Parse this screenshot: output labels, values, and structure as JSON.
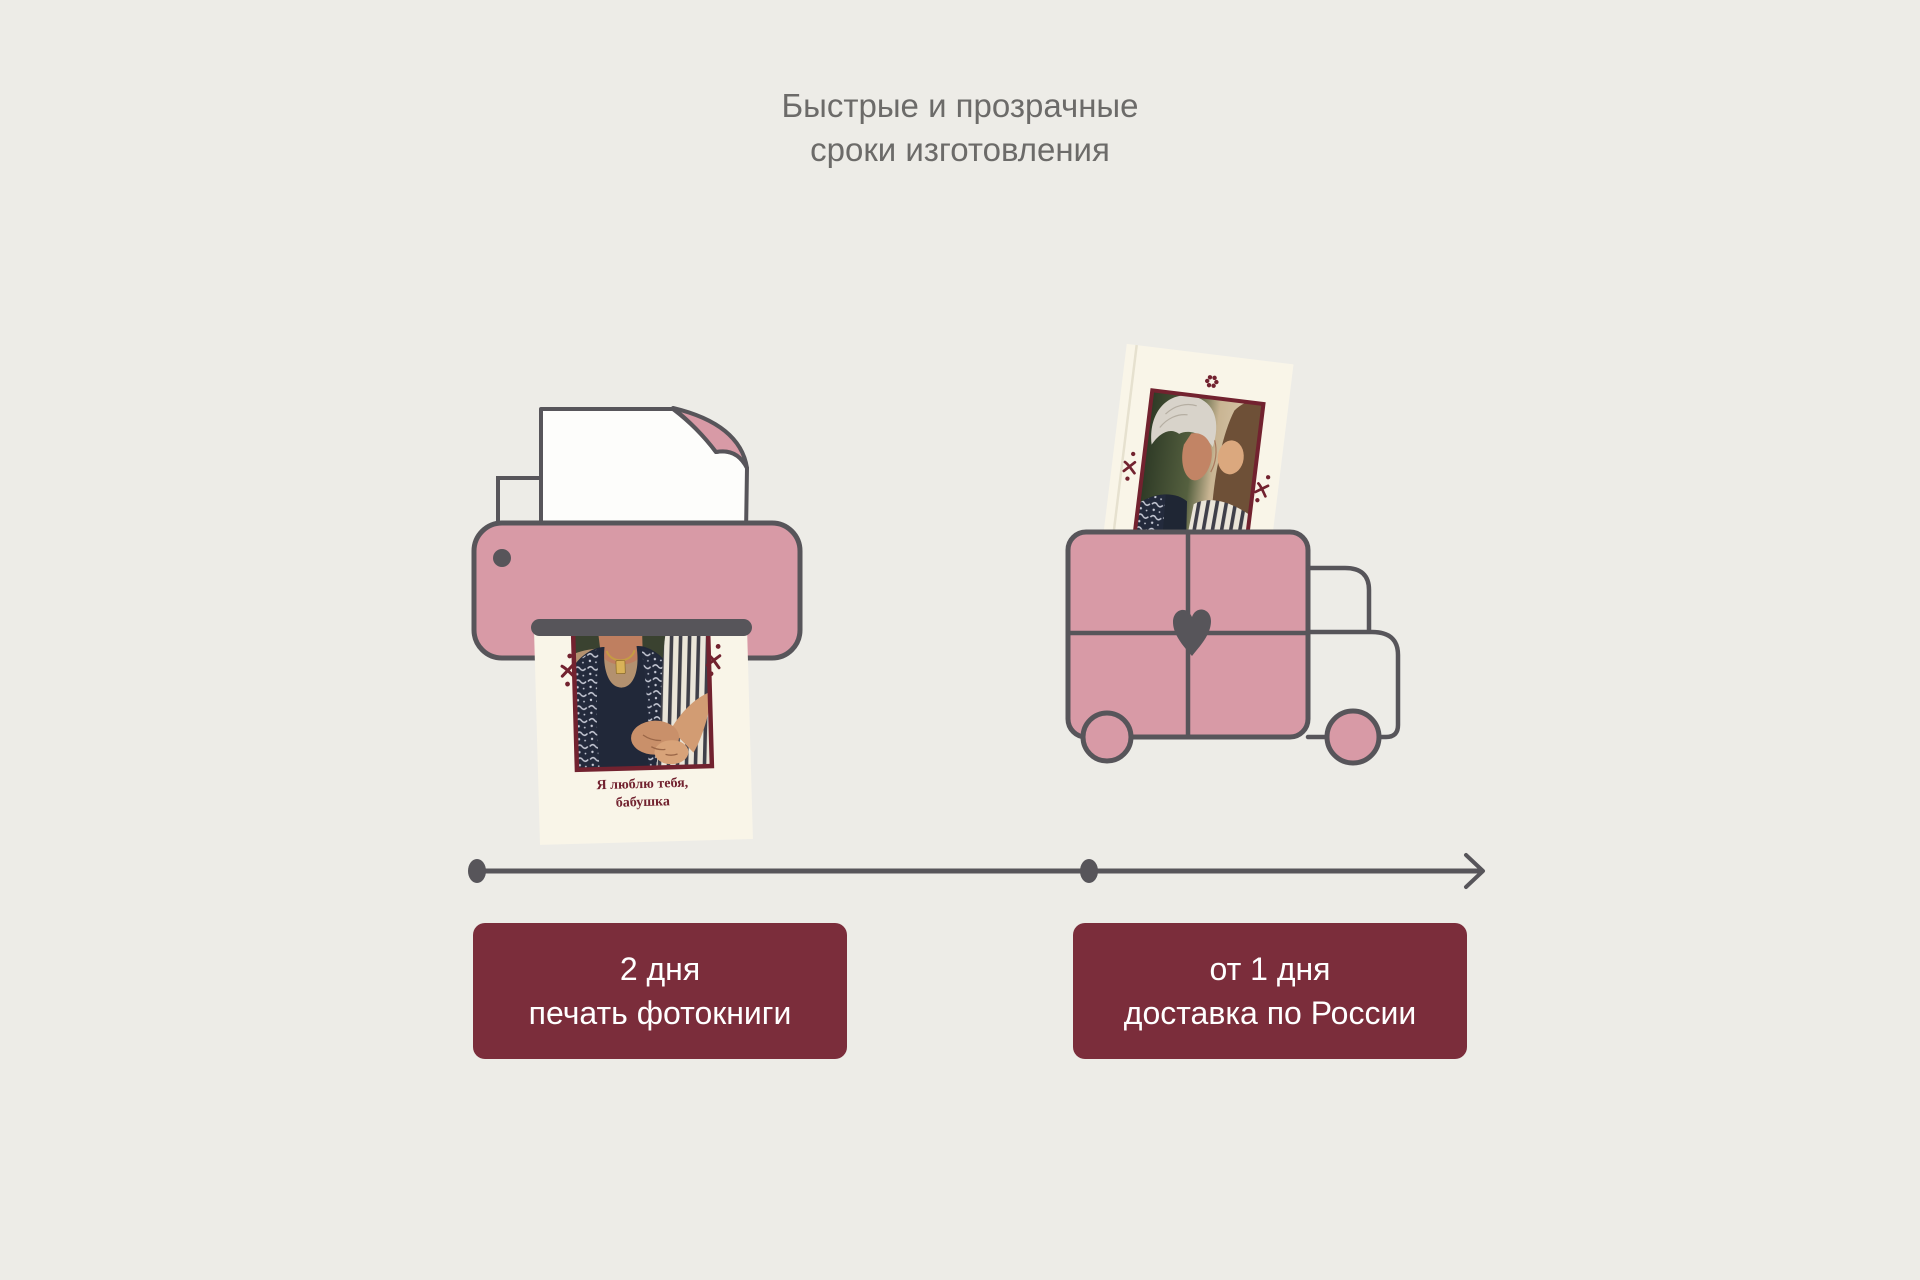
{
  "title": {
    "line1": "Быстрые и прозрачные",
    "line2": "сроки изготовления"
  },
  "printer_page": {
    "caption_line1": "Я люблю тебя,",
    "caption_line2": "бабушка"
  },
  "steps": [
    {
      "duration": "2 дня",
      "label": "печать фотокниги"
    },
    {
      "duration": "от 1 дня",
      "label": "доставка по России"
    }
  ],
  "timeline": {
    "type": "left-to-right arrow",
    "milestone_count": 2
  },
  "icons": {
    "printer": "printer-printing-photobook-page",
    "truck": "delivery-truck-with-photobook",
    "heart": "heart",
    "flower": "flower-ornament",
    "x_ornament": "brush-cross-ornament",
    "arrow": "arrow-right"
  },
  "colors": {
    "background": "#edece7",
    "pink": "#d89aa6",
    "outline_gray": "#57555a",
    "maroon": "#7b2d3b",
    "maroon_dark": "#72222f",
    "cream": "#f9f5e8",
    "paper_white": "#fdfdfb",
    "title_text": "#6c6b69",
    "button_text": "#ffffff"
  }
}
